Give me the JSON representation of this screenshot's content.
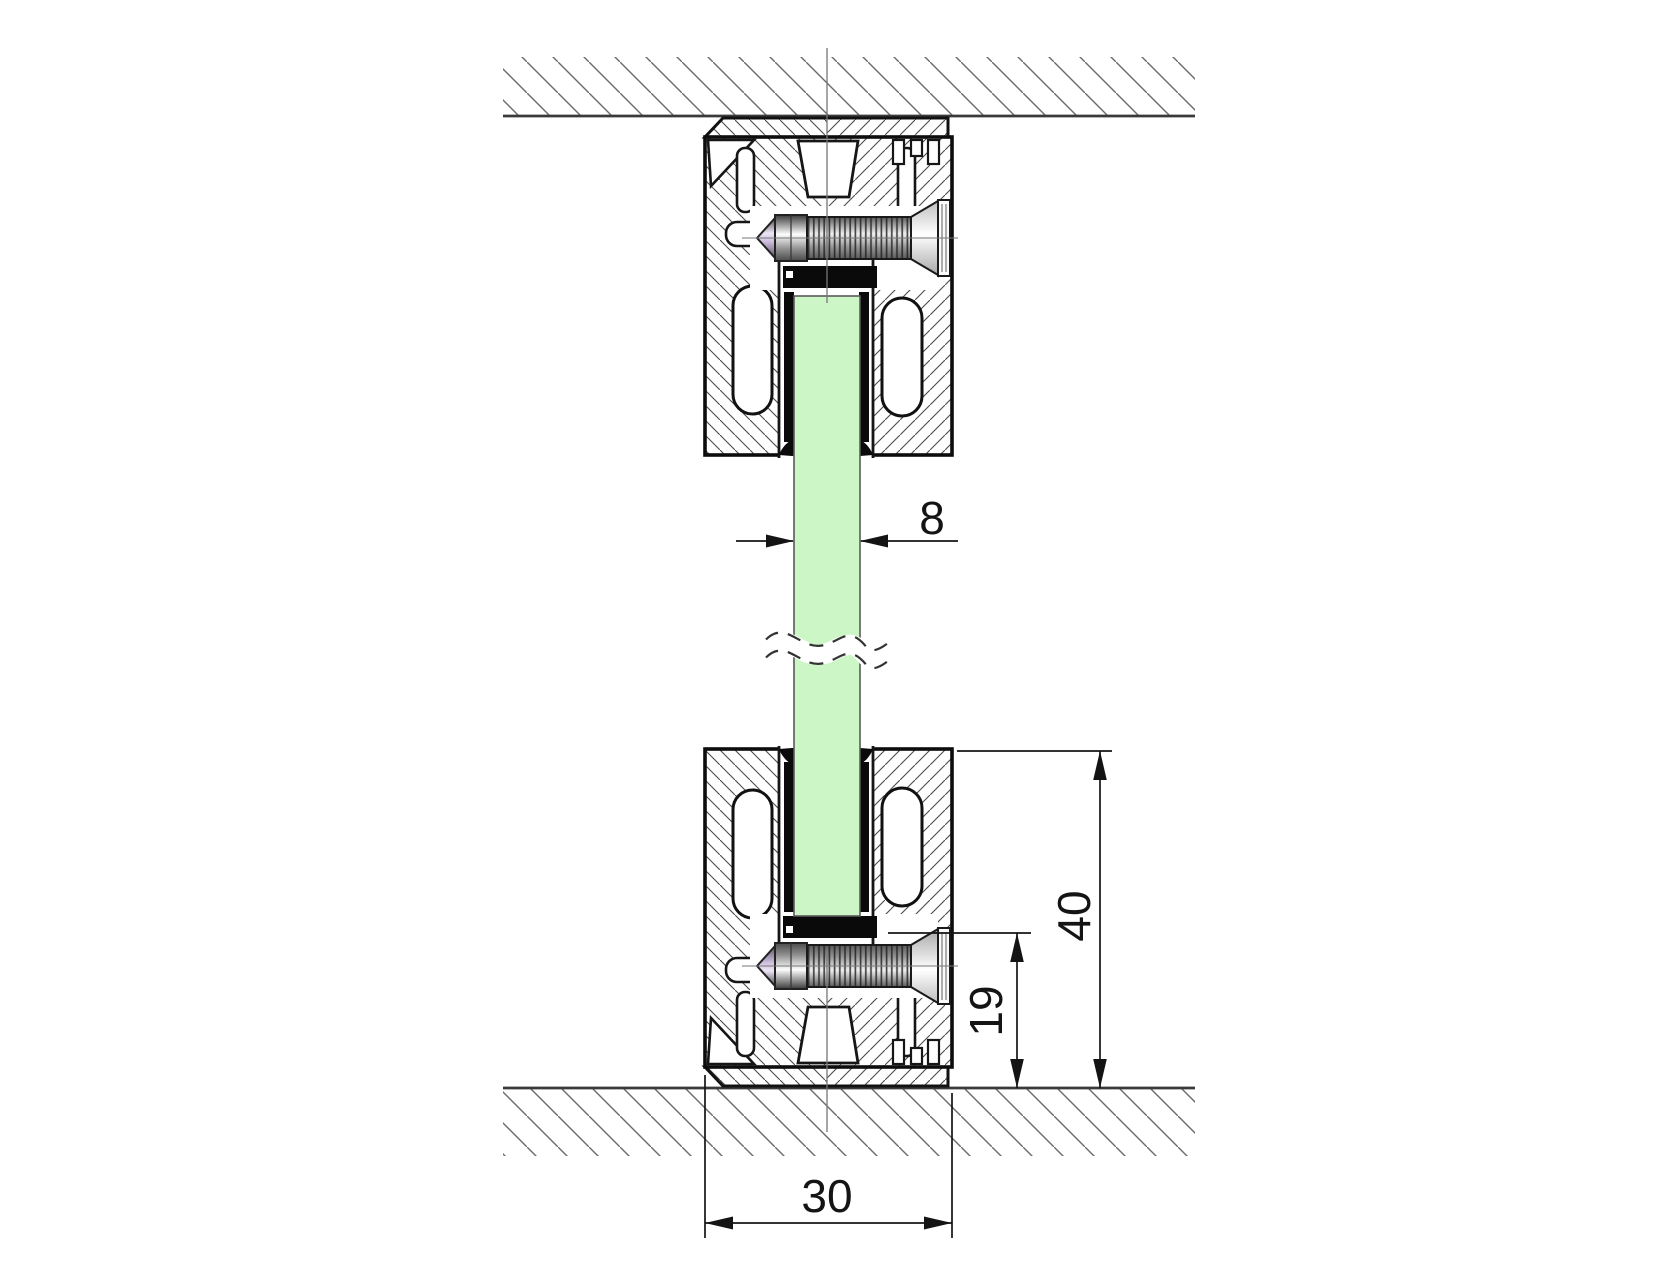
{
  "drawing": {
    "kind": "technical-section-drawing",
    "description": "Vertical cross-section of a glass partition clamped in aluminium floor and ceiling profiles",
    "dimensions": {
      "glass_thickness": {
        "label": "8",
        "value": 8,
        "unit": "mm",
        "orientation": "horizontal",
        "measures": "glass panel thickness"
      },
      "profile_height": {
        "label": "40",
        "value": 40,
        "unit": "mm",
        "orientation": "vertical",
        "measures": "profile overall height above floor"
      },
      "glass_seat_height": {
        "label": "19",
        "value": 19,
        "unit": "mm",
        "orientation": "vertical",
        "measures": "glass seat to floor"
      },
      "profile_width": {
        "label": "30",
        "value": 30,
        "unit": "mm",
        "orientation": "horizontal",
        "measures": "profile overall width"
      }
    },
    "colors": {
      "background": "#ffffff",
      "glass": "#cdf6c7",
      "outline": "#111111",
      "hatch": "#5a5a5a",
      "gasket": "#0a0a0a",
      "dimension": "#141414"
    },
    "components": [
      "ceiling-hatch",
      "ceiling-line",
      "top-clamp-profile",
      "bottom-clamp-profile",
      "glass-panel",
      "glass-break-lines",
      "set-screw",
      "countersunk-screw",
      "rubber-gaskets",
      "floor-line",
      "floor-hatch",
      "centerline"
    ]
  }
}
